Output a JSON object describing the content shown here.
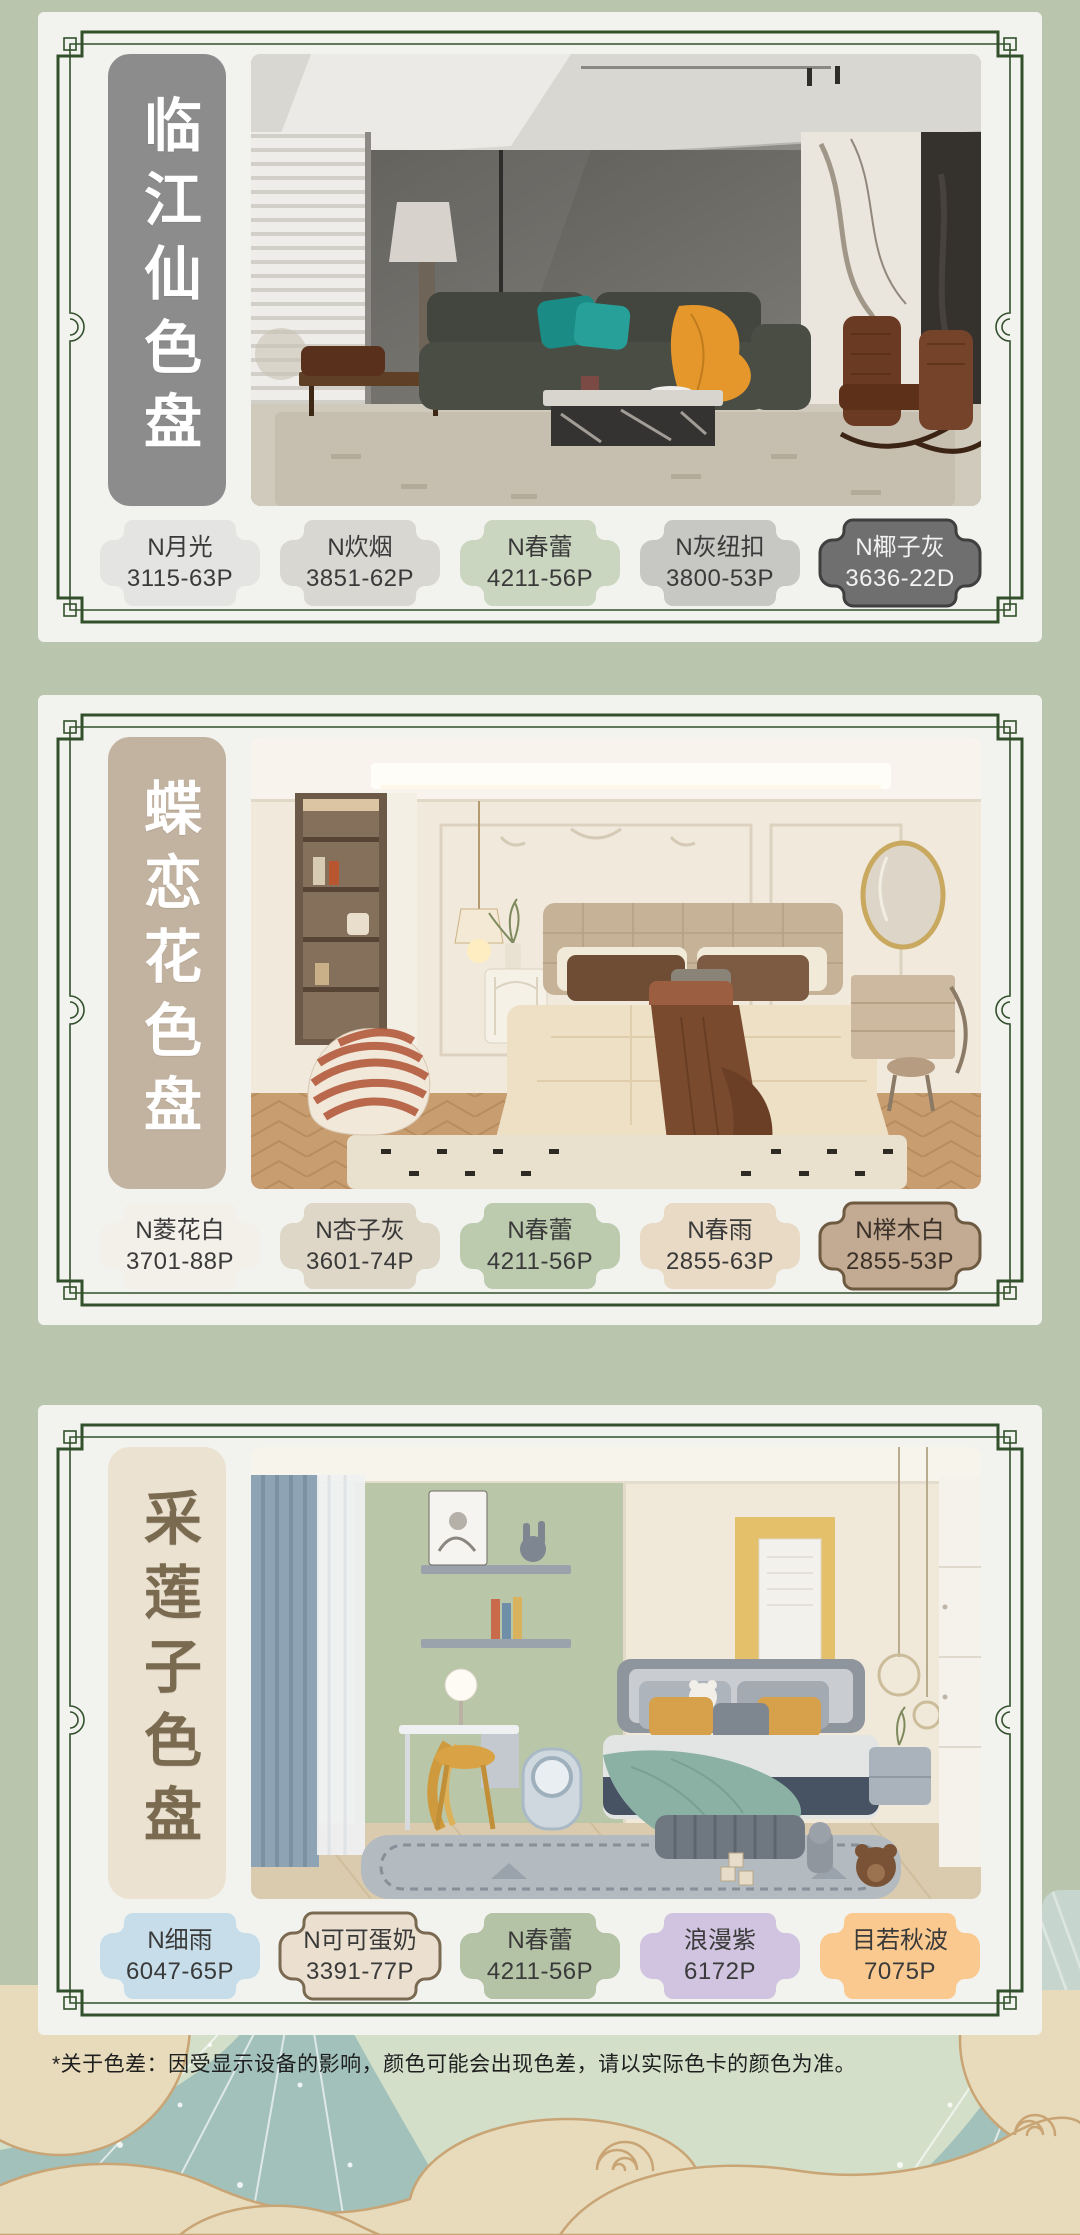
{
  "page": {
    "bg": "#b9c5ad",
    "card_bg": "#f2f3ee",
    "footnote": "*关于色差：因受显示设备的影响，颜色可能会出现色差，请以实际色卡的颜色为准。",
    "footnote_color": "#1f1f1f"
  },
  "frame": {
    "color": "#33502c"
  },
  "illustration": {
    "sky": "#d3dfc9",
    "teal": "#a2c1ba",
    "sand": "#e7dbbc",
    "outline": "#c9a474"
  },
  "cards": [
    {
      "title": "临江仙色盘",
      "title_bg": "#8c8c8c",
      "title_color": "#ffffff",
      "photo": "modern-living-room",
      "swatches": [
        {
          "name": "N月光",
          "code": "3115-63P",
          "fill": "#e4e4e2",
          "text": "#3a3a3a",
          "border": "none"
        },
        {
          "name": "N炊烟",
          "code": "3851-62P",
          "fill": "#d8d7d2",
          "text": "#3a3a3a",
          "border": "none"
        },
        {
          "name": "N春蕾",
          "code": "4211-56P",
          "fill": "#cbd6c0",
          "text": "#3a3a3a",
          "border": "none"
        },
        {
          "name": "N灰纽扣",
          "code": "3800-53P",
          "fill": "#c7c8c4",
          "text": "#3a3a3a",
          "border": "none"
        },
        {
          "name": "N椰子灰",
          "code": "3636-22D",
          "fill": "#6f6f6f",
          "text": "#f2f2f2",
          "border": "#3f3f3f"
        }
      ]
    },
    {
      "title": "蝶恋花色盘",
      "title_bg": "#c2b2a0",
      "title_color": "#ffffff",
      "photo": "french-cream-bedroom",
      "swatches": [
        {
          "name": "N菱花白",
          "code": "3701-88P",
          "fill": "#f3f0e9",
          "text": "#3a3a3a",
          "border": "none"
        },
        {
          "name": "N杏子灰",
          "code": "3601-74P",
          "fill": "#ded6c6",
          "text": "#3a3a3a",
          "border": "none"
        },
        {
          "name": "N春蕾",
          "code": "4211-56P",
          "fill": "#bccaae",
          "text": "#3a3a3a",
          "border": "none"
        },
        {
          "name": "N春雨",
          "code": "2855-63P",
          "fill": "#e8dac5",
          "text": "#3a3a3a",
          "border": "none"
        },
        {
          "name": "N榉木白",
          "code": "2855-53P",
          "fill": "#c3ab93",
          "text": "#3b3128",
          "border": "#6e5a41"
        }
      ]
    },
    {
      "title": "采莲子色盘",
      "title_bg": "#ece2d2",
      "title_color": "#7a6a50",
      "photo": "kids-bedroom",
      "swatches": [
        {
          "name": "N细雨",
          "code": "6047-65P",
          "fill": "#c7deea",
          "text": "#3a3a3a",
          "border": "none"
        },
        {
          "name": "N可可蛋奶",
          "code": "3391-77P",
          "fill": "#ebe0d0",
          "text": "#3a3a3a",
          "border": "#7a6a52"
        },
        {
          "name": "N春蕾",
          "code": "4211-56P",
          "fill": "#b4c2a5",
          "text": "#3a3a3a",
          "border": "none"
        },
        {
          "name": "浪漫紫",
          "code": "6172P",
          "fill": "#d0c4e0",
          "text": "#3a3a3a",
          "border": "none"
        },
        {
          "name": "目若秋波",
          "code": "7075P",
          "fill": "#fac98f",
          "text": "#3a3a3a",
          "border": "none"
        }
      ]
    }
  ]
}
